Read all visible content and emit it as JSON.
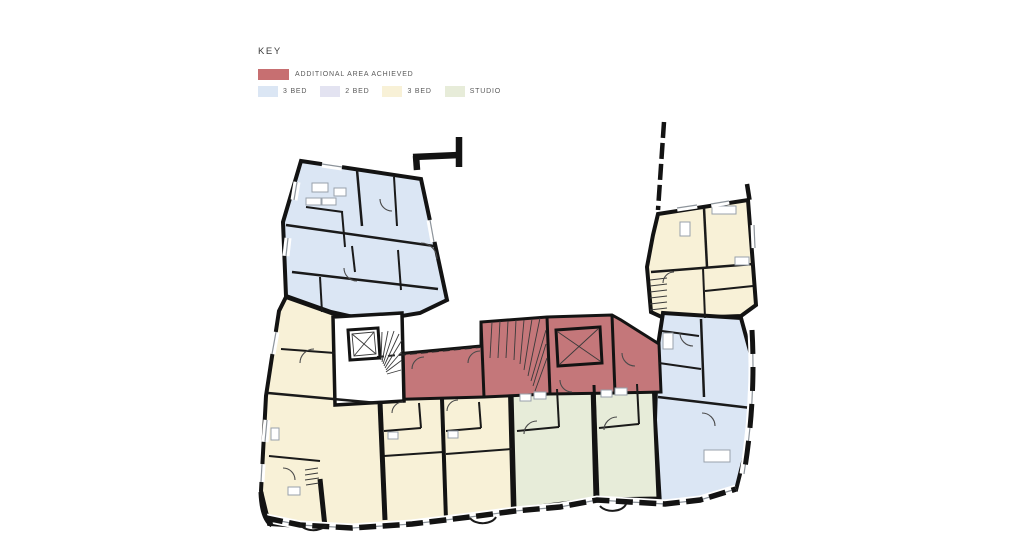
{
  "legend": {
    "title": "KEY",
    "additional": {
      "label": "ADDITIONAL AREA ACHIEVED",
      "color": "#c76f71"
    },
    "items": [
      {
        "label": "3 BED",
        "color": "#dbe6f4"
      },
      {
        "label": "2 BED",
        "color": "#e3e3f1"
      },
      {
        "label": "3 BED",
        "color": "#f8f1d7"
      },
      {
        "label": "STUDIO",
        "color": "#e7ecd9"
      }
    ]
  },
  "plan": {
    "colors": {
      "bed3_blue": "#dbe6f4",
      "bed2_lavender": "#e3e3f1",
      "bed3_yellow": "#f8f1d7",
      "studio_green": "#e7ecd9",
      "additional_area": "#c4777a",
      "wall": "#131313"
    },
    "units": [
      {
        "id": "unit-top-left",
        "legend_type": "3 BED"
      },
      {
        "id": "unit-top-right",
        "legend_type": "3 BED"
      },
      {
        "id": "unit-right",
        "legend_type": "3 BED"
      },
      {
        "id": "unit-left",
        "legend_type": "3 BED"
      },
      {
        "id": "studio-1",
        "legend_type": "STUDIO"
      },
      {
        "id": "studio-2",
        "legend_type": "STUDIO"
      },
      {
        "id": "core-band",
        "legend_type": "ADDITIONAL AREA ACHIEVED"
      }
    ]
  }
}
